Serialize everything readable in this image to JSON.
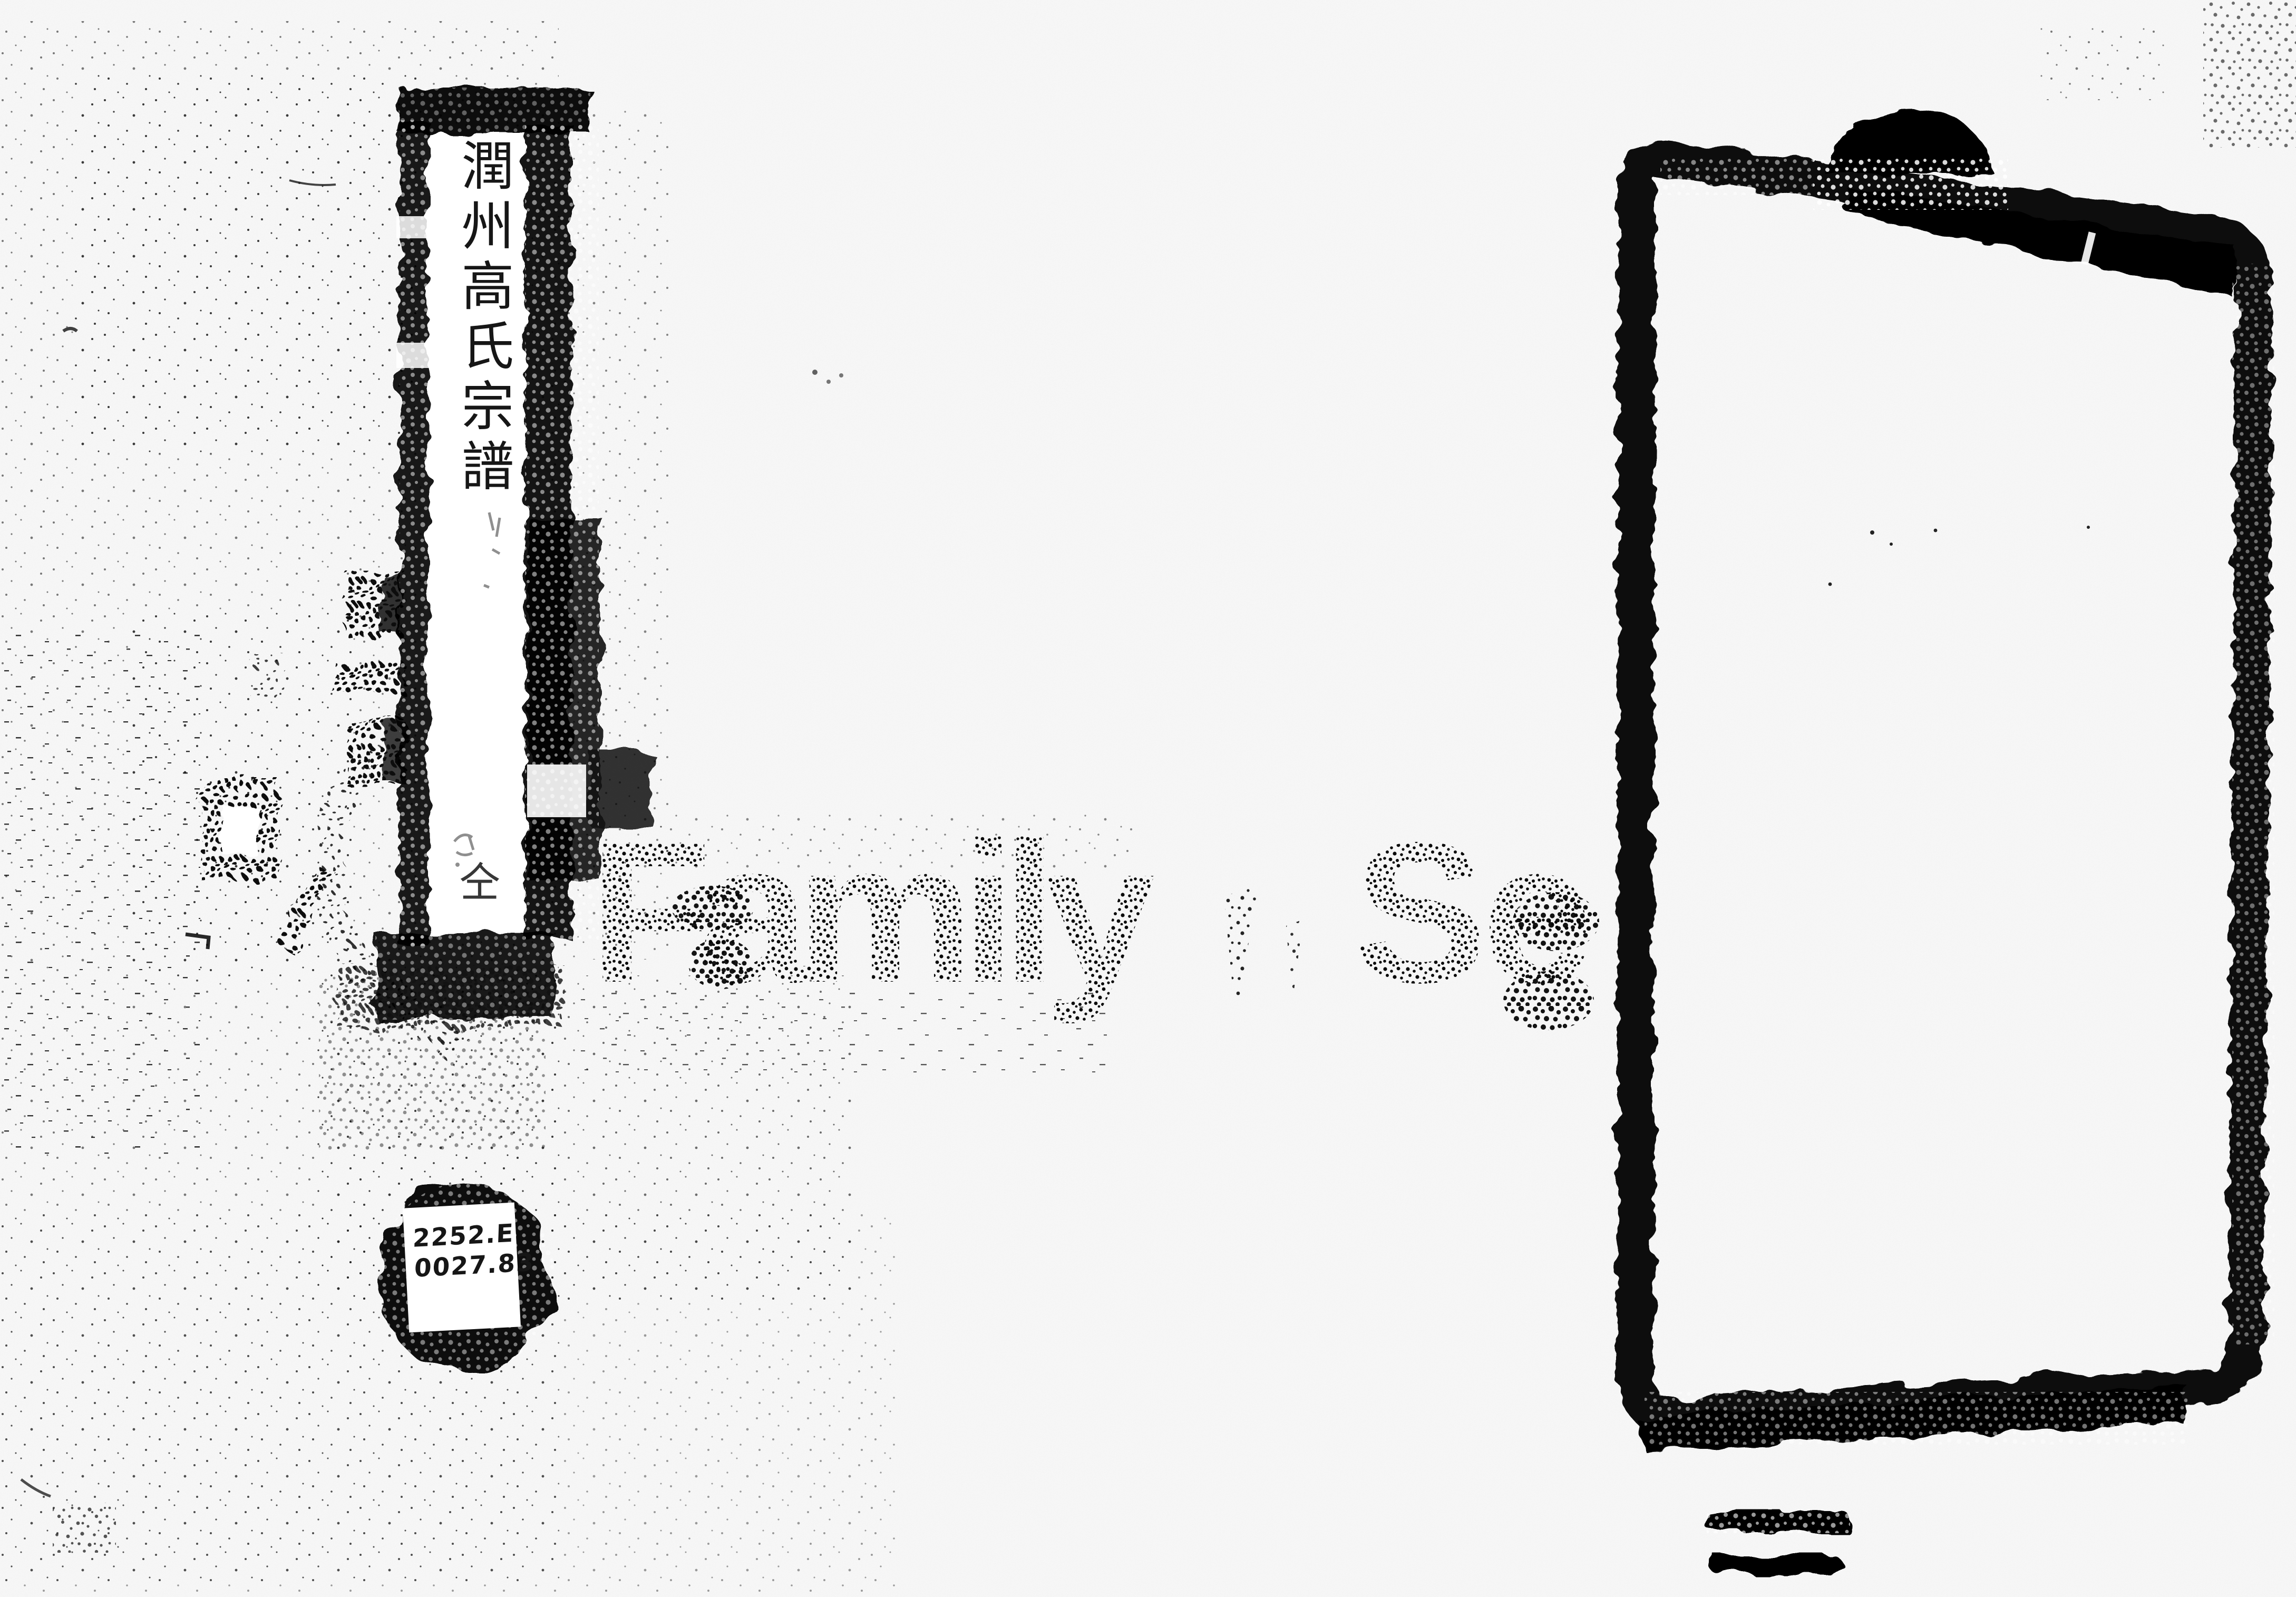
{
  "title_strip": {
    "vertical_title": "潤州高氏宗譜",
    "annotation_character": "仝"
  },
  "call_number_sticker": {
    "line1": "2252.E",
    "line2": "0027.83"
  },
  "watermark": {
    "text_left": "Family",
    "text_right": "Se"
  },
  "colors": {
    "paper": "#ffffff",
    "ink": "#000000"
  }
}
